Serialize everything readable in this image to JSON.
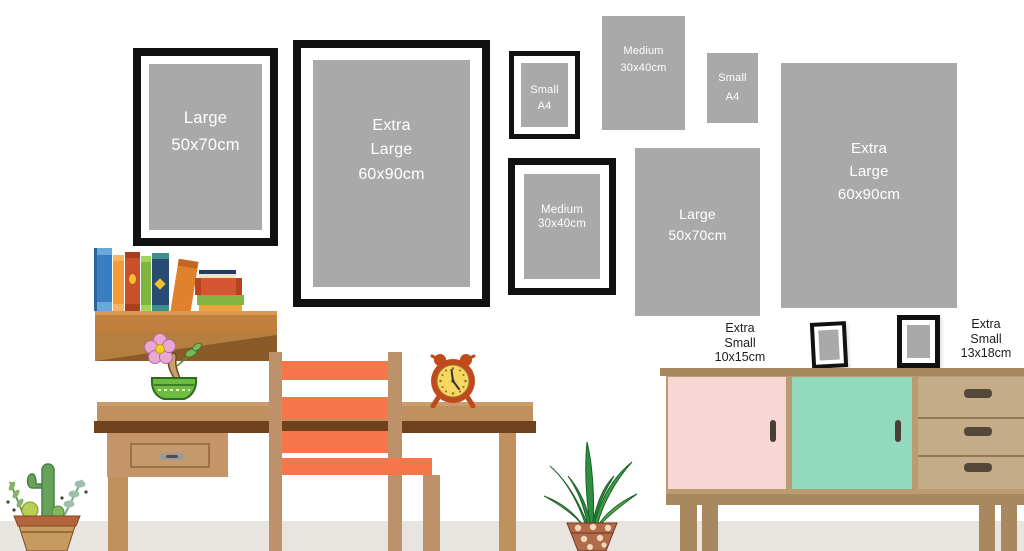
{
  "frames": [
    {
      "name": "frame-large-50x70-framed",
      "style": "black-frame",
      "lines": [
        "Large",
        "50x70cm"
      ]
    },
    {
      "name": "frame-extra-large-60x90-framed",
      "style": "black-frame",
      "lines": [
        "Extra",
        "Large",
        "60x90cm"
      ]
    },
    {
      "name": "frame-small-a4-framed",
      "style": "black-frame",
      "lines": [
        "Small",
        "A4"
      ]
    },
    {
      "name": "print-medium-30x40",
      "style": "frameless-print",
      "lines": [
        "Medium",
        "30x40cm"
      ]
    },
    {
      "name": "print-small-a4",
      "style": "frameless-print",
      "lines": [
        "Small",
        "A4"
      ]
    },
    {
      "name": "frame-medium-30x40-framed",
      "style": "black-frame",
      "lines": [
        "Medium",
        "30x40cm"
      ]
    },
    {
      "name": "print-large-50x70",
      "style": "frameless-print",
      "lines": [
        "Large",
        "50x70cm"
      ]
    },
    {
      "name": "print-extra-large-60x90",
      "style": "frameless-print",
      "lines": [
        "Extra",
        "Large",
        "60x90cm"
      ]
    },
    {
      "name": "photo-extra-small-10x15",
      "style": "black-frame",
      "lines": []
    },
    {
      "name": "photo-extra-small-13x18",
      "style": "black-frame",
      "lines": []
    }
  ],
  "standing_labels": [
    {
      "lines": [
        "Extra",
        "Small",
        "10x15cm"
      ]
    },
    {
      "lines": [
        "Extra",
        "Small",
        "13x18cm"
      ]
    }
  ],
  "colors": {
    "wall": "#ffffff",
    "floor": "#e8e4df",
    "print_gray": "#a9a9a9",
    "frame_black": "#111111",
    "mat_white": "#ffffff",
    "label_text": "#1c1c1c",
    "print_text": "#ffffff",
    "desk_wood": "#c0905e",
    "desk_edge_dark": "#6f411c",
    "chair_wood": "#bd9169",
    "chair_orange": "#f5764a",
    "shelf_brown": "#c07f3d",
    "shelf_shadow": "#8a5a28",
    "sideboard_trim": "#a8885e",
    "sideboard_body": "#bb9b72",
    "door_pink": "#f8d6d5",
    "door_mint": "#92d9bd",
    "drawer_tan": "#c5ac89",
    "handle_dark": "#4a3f33",
    "clock_red": "#c04a1c",
    "clock_face": "#f6d860",
    "bowl_green": "#6cbd41",
    "terracotta": "#c79b5f",
    "aloe_pot": "#b06b48"
  },
  "scene_objects": [
    "bookshelf",
    "books",
    "desk",
    "chair",
    "alarm-clock",
    "bonsai-flower-pot",
    "cactus-pot",
    "aloe-plant",
    "sideboard"
  ]
}
